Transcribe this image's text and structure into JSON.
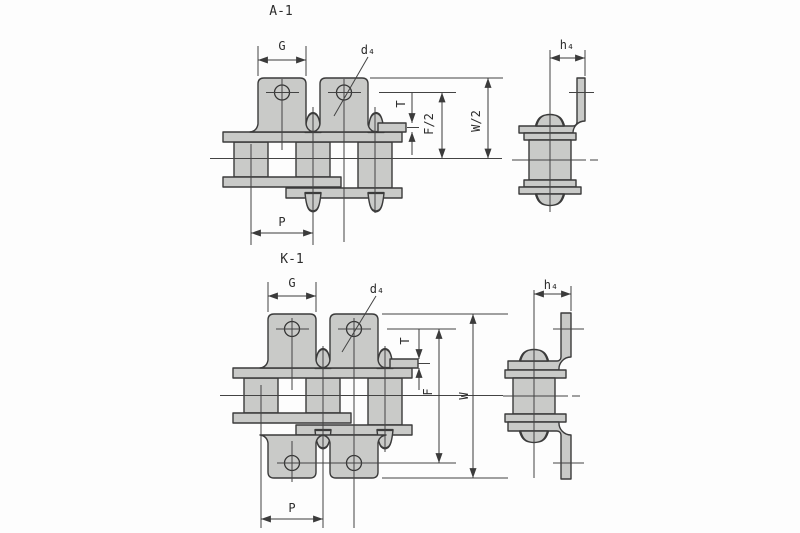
{
  "diagram": {
    "kind": "roller-chain-attachment-technical-drawing",
    "colors": {
      "plate_fill": "#c9cac8",
      "line": "#3b3b3b",
      "background": "#fdfdfd"
    },
    "sections": [
      {
        "title": "A-1",
        "labels": {
          "g": "G",
          "d4": "d₄",
          "h4": "h₄",
          "t": "T",
          "f_half": "F/2",
          "w_half": "W/2",
          "p": "P"
        }
      },
      {
        "title": "K-1",
        "labels": {
          "g": "G",
          "d4": "d₄",
          "h4": "h₄",
          "t": "T",
          "f": "F",
          "w": "W",
          "p": "P"
        }
      }
    ]
  }
}
